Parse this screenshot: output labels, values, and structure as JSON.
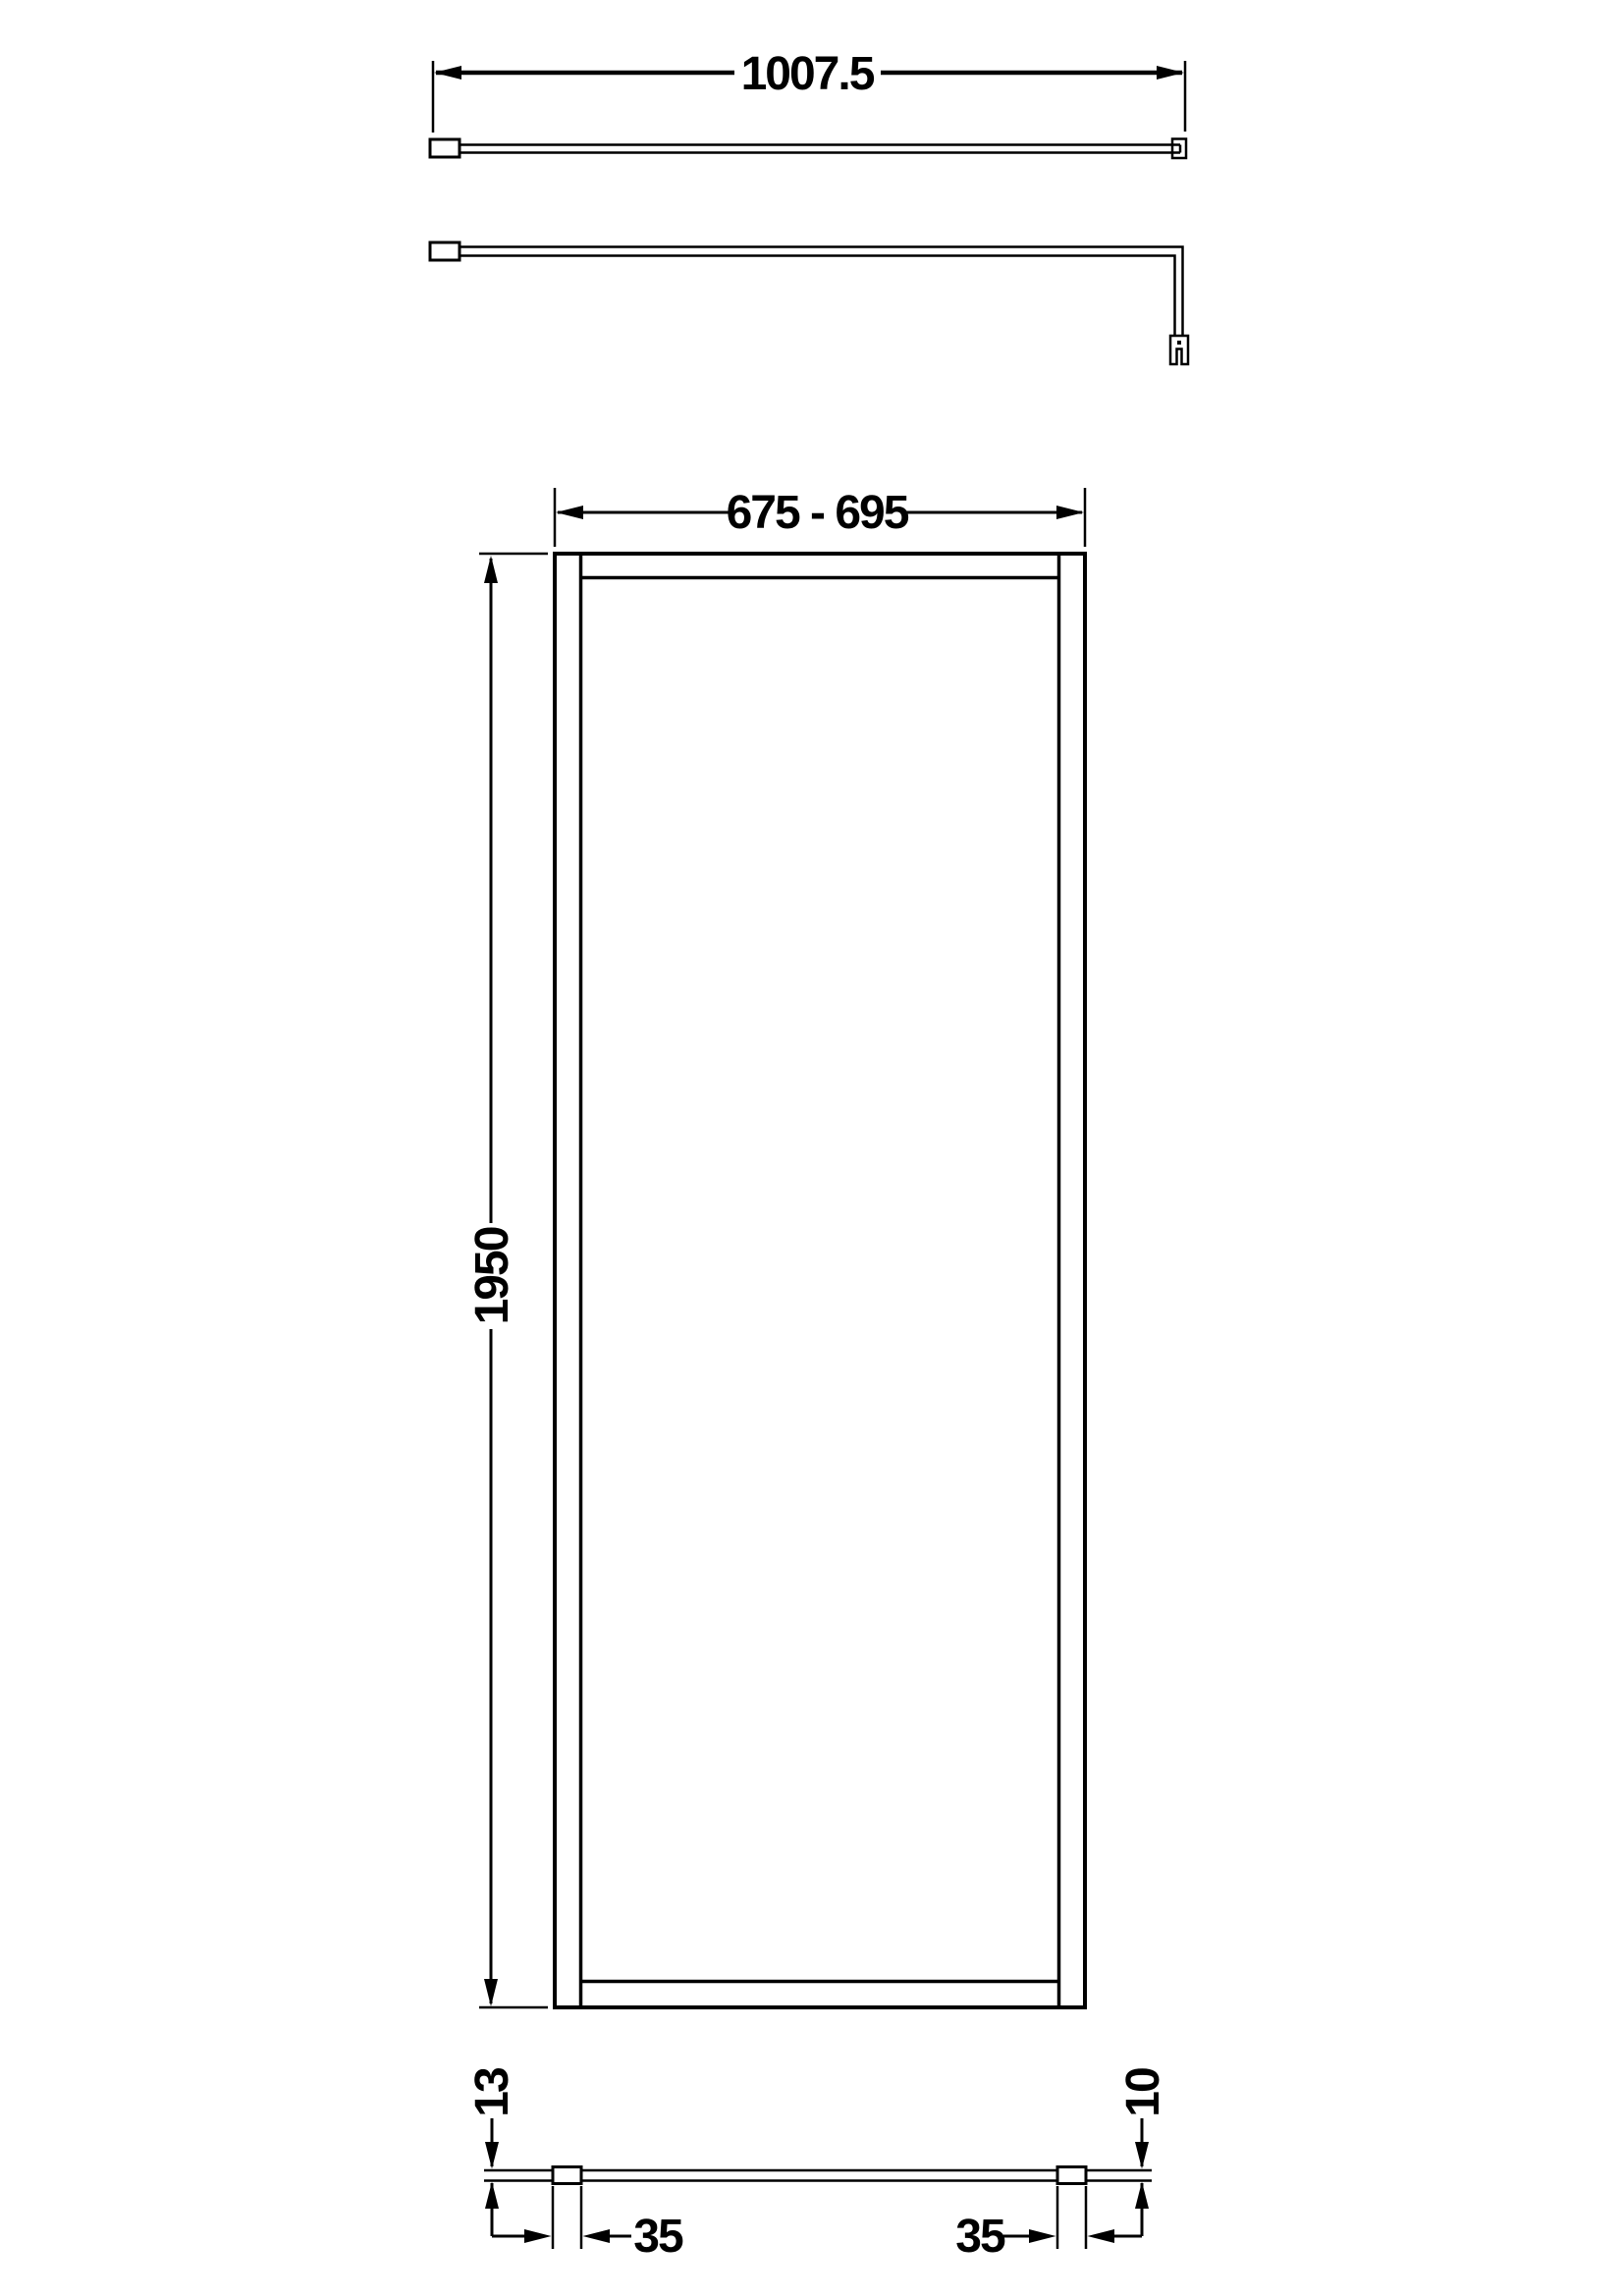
{
  "colors": {
    "background": "#ffffff",
    "line": "#000000"
  },
  "dimensions": {
    "support_bar_length": "1007.5",
    "panel_width_range": "675 - 695",
    "panel_height": "1950",
    "left_profile_depth": "13",
    "left_profile_width": "35",
    "right_profile_width": "35",
    "glass_thickness": "10"
  }
}
